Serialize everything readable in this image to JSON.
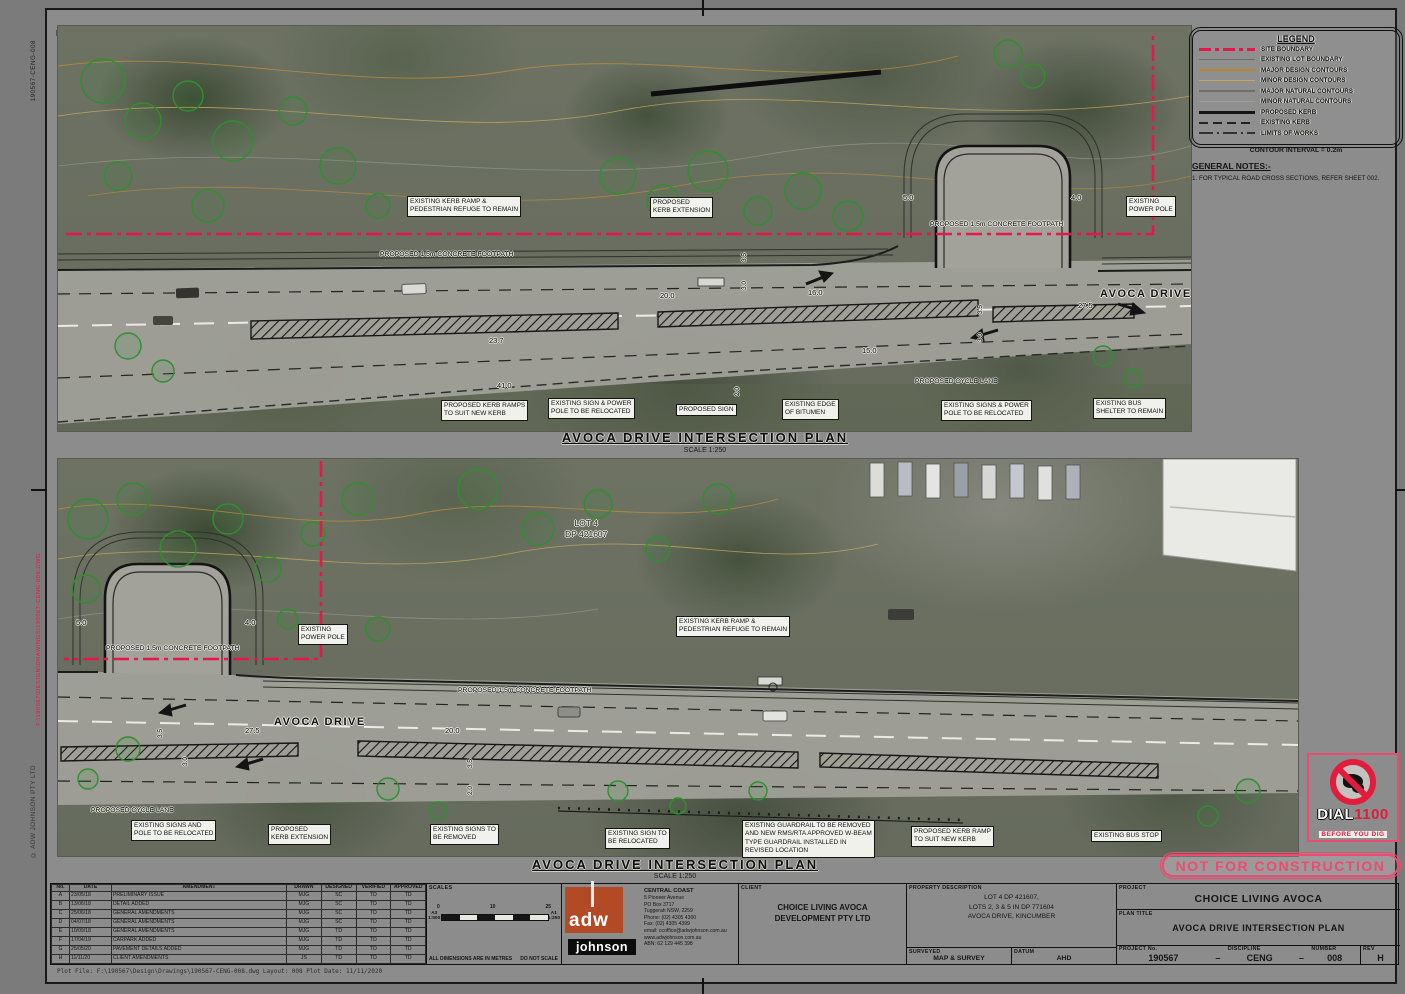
{
  "sheet": {
    "paper_color": "#8c8c8c",
    "accent_red": "#e8174a",
    "stamp_pink": "#ef4a70"
  },
  "north_label": "N",
  "vertical_margin_texts": {
    "drawing_ref": "190567-CENG-008",
    "red_stamp": "F:\\190567\\DESIGN\\DRAWINGS\\190567-CENG-008.DWG",
    "copyright": "© ADW JOHNSON PTY LTD"
  },
  "legend": {
    "title": "LEGEND",
    "items": [
      {
        "label": "SITE BOUNDARY",
        "line_class": "ls-site",
        "icon": "site-boundary-line-icon",
        "color": "#e8174a"
      },
      {
        "label": "EXISTING LOT BOUNDARY",
        "line_class": "ls-lot",
        "icon": "lot-boundary-line-icon",
        "color": "#6d6d66"
      },
      {
        "label": "MAJOR DESIGN CONTOURS",
        "line_class": "ls-majd",
        "icon": "major-design-contour-line-icon",
        "color": "#b5872f"
      },
      {
        "label": "MINOR DESIGN CONTOURS",
        "line_class": "ls-mind",
        "icon": "minor-design-contour-line-icon",
        "color": "#c7a55c"
      },
      {
        "label": "MAJOR NATURAL CONTOURS",
        "line_class": "ls-majn",
        "icon": "major-natural-contour-line-icon",
        "color": "#70706a"
      },
      {
        "label": "MINOR NATURAL CONTOURS",
        "line_class": "ls-minn",
        "icon": "minor-natural-contour-line-icon",
        "color": "#9d9d95"
      },
      {
        "label": "PROPOSED KERB",
        "line_class": "ls-pkerb",
        "icon": "proposed-kerb-line-icon",
        "color": "#151515"
      },
      {
        "label": "EXISTING KERB",
        "line_class": "ls-ekerb",
        "icon": "existing-kerb-line-icon",
        "color": "#222222"
      },
      {
        "label": "LIMITS OF WORKS",
        "line_class": "ls-limits",
        "icon": "limits-of-works-line-icon",
        "color": "#333333"
      }
    ],
    "contour_interval": "CONTOUR INTERVAL = 0.2m"
  },
  "general_notes": {
    "title": "GENERAL NOTES:-",
    "notes": [
      "1.  FOR TYPICAL ROAD CROSS SECTIONS, REFER SHEET 002."
    ]
  },
  "plans": [
    {
      "title": "AVOCA DRIVE INTERSECTION PLAN",
      "subtitle": "SCALE 1:250",
      "labels": [
        {
          "kind": "box",
          "x": 407,
          "y": 196,
          "text": "EXISTING KERB RAMP &\nPEDESTRIAN REFUGE TO REMAIN"
        },
        {
          "kind": "box",
          "x": 650,
          "y": 197,
          "text": "PROPOSED\nKERB EXTENSION"
        },
        {
          "kind": "plain",
          "x": 930,
          "y": 221,
          "text": "PROPOSED 1.5m CONCRETE FOOTPATH"
        },
        {
          "kind": "box",
          "x": 1126,
          "y": 196,
          "text": "EXISTING\nPOWER POLE"
        },
        {
          "kind": "plain",
          "x": 380,
          "y": 251,
          "text": "PROPOSED 1.5m CONCRETE FOOTPATH"
        },
        {
          "kind": "road",
          "x": 1100,
          "y": 288,
          "text": "AVOCA DRIVE"
        },
        {
          "kind": "plain",
          "x": 915,
          "y": 378,
          "text": "PROPOSED CYCLE LANE"
        },
        {
          "kind": "box",
          "x": 441,
          "y": 400,
          "text": "PROPOSED KERB RAMPS\nTO SUIT NEW KERB"
        },
        {
          "kind": "box",
          "x": 548,
          "y": 398,
          "text": "EXISTING SIGN & POWER\nPOLE TO BE RELOCATED"
        },
        {
          "kind": "box",
          "x": 676,
          "y": 404,
          "text": "PROPOSED SIGN"
        },
        {
          "kind": "box",
          "x": 782,
          "y": 399,
          "text": "EXISTING EDGE\nOF BITUMEN"
        },
        {
          "kind": "box",
          "x": 941,
          "y": 400,
          "text": "EXISTING SIGNS & POWER\nPOLE TO BE RELOCATED"
        },
        {
          "kind": "box",
          "x": 1093,
          "y": 398,
          "text": "EXISTING BUS\nSHELTER TO REMAIN"
        },
        {
          "kind": "dim",
          "x": 903,
          "y": 193,
          "text": "5.0"
        },
        {
          "kind": "dim",
          "x": 1071,
          "y": 193,
          "text": "4.0"
        },
        {
          "kind": "dim",
          "x": 660,
          "y": 291,
          "text": "20.0"
        },
        {
          "kind": "dim",
          "x": 808,
          "y": 288,
          "text": "16.0"
        },
        {
          "kind": "dim",
          "x": 1078,
          "y": 301,
          "text": "27.5"
        },
        {
          "kind": "dim",
          "x": 489,
          "y": 336,
          "text": "23.7"
        },
        {
          "kind": "dim",
          "x": 862,
          "y": 346,
          "text": "15.0"
        },
        {
          "kind": "dim",
          "x": 497,
          "y": 381,
          "text": "41.0"
        },
        {
          "kind": "vdim",
          "x": 741,
          "y": 262,
          "text": "3.5"
        },
        {
          "kind": "vdim",
          "x": 741,
          "y": 290,
          "text": "3.0"
        },
        {
          "kind": "vdim",
          "x": 977,
          "y": 314,
          "text": "3.5"
        },
        {
          "kind": "vdim",
          "x": 977,
          "y": 342,
          "text": "3.0"
        },
        {
          "kind": "vdim",
          "x": 734,
          "y": 396,
          "text": "2.0"
        }
      ]
    },
    {
      "title": "AVOCA DRIVE INTERSECTION PLAN",
      "subtitle": "SCALE 1:250",
      "labels": [
        {
          "kind": "dim",
          "x": 76,
          "y": 618,
          "text": "5.0"
        },
        {
          "kind": "dim",
          "x": 245,
          "y": 618,
          "text": "4.0"
        },
        {
          "kind": "box",
          "x": 298,
          "y": 624,
          "text": "EXISTING\nPOWER POLE"
        },
        {
          "kind": "plain",
          "x": 106,
          "y": 645,
          "text": "PROPOSED 1.5m CONCRETE FOOTPATH"
        },
        {
          "kind": "box",
          "x": 676,
          "y": 616,
          "text": "EXISTING KERB RAMP &\nPEDESTRIAN REFUGE TO REMAIN"
        },
        {
          "kind": "plain",
          "x": 458,
          "y": 687,
          "text": "PROPOSED 1.5m CONCRETE FOOTPATH"
        },
        {
          "kind": "road",
          "x": 274,
          "y": 716,
          "text": "AVOCA DRIVE"
        },
        {
          "kind": "lot",
          "x": 565,
          "y": 518,
          "text": "LOT 4\nDP 421607"
        },
        {
          "kind": "dim",
          "x": 245,
          "y": 726,
          "text": "27.5"
        },
        {
          "kind": "dim",
          "x": 445,
          "y": 726,
          "text": "20.0"
        },
        {
          "kind": "vdim",
          "x": 157,
          "y": 738,
          "text": "3.5"
        },
        {
          "kind": "vdim",
          "x": 182,
          "y": 766,
          "text": "3.0"
        },
        {
          "kind": "vdim",
          "x": 467,
          "y": 768,
          "text": "3.5"
        },
        {
          "kind": "vdim",
          "x": 467,
          "y": 795,
          "text": "2.0"
        },
        {
          "kind": "plain",
          "x": 91,
          "y": 807,
          "text": "PROPOSED CYCLE LANE"
        },
        {
          "kind": "box",
          "x": 131,
          "y": 820,
          "text": "EXISTING SIGNS AND\nPOLE TO BE RELOCATED"
        },
        {
          "kind": "box",
          "x": 268,
          "y": 824,
          "text": "PROPOSED\nKERB EXTENSION"
        },
        {
          "kind": "box",
          "x": 430,
          "y": 824,
          "text": "EXISTING SIGNS TO\nBE REMOVED"
        },
        {
          "kind": "box",
          "x": 605,
          "y": 828,
          "text": "EXISTING SIGN TO\nBE RELOCATED"
        },
        {
          "kind": "box",
          "x": 742,
          "y": 820,
          "text": "EXISTING GUARDRAIL TO BE REMOVED\nAND NEW RMS/RTA APPROVED W-BEAM\nTYPE GUARDRAIL INSTALLED IN\nREVISED LOCATION"
        },
        {
          "kind": "box",
          "x": 911,
          "y": 826,
          "text": "PROPOSED KERB RAMP\nTO SUIT NEW KERB"
        },
        {
          "kind": "box",
          "x": 1091,
          "y": 830,
          "text": "EXISTING BUS STOP"
        }
      ]
    }
  ],
  "stamps": {
    "not_for_construction": "NOT FOR CONSTRUCTION",
    "dial": {
      "line1": "DIAL",
      "line2": "1100",
      "line3": "BEFORE YOU DIG"
    }
  },
  "title_block": {
    "revision_table": {
      "headers": [
        "No.",
        "DATE",
        "AMENDMENT",
        "DRAWN",
        "DESIGNED",
        "VERIFIED",
        "APPROVED"
      ],
      "rows": [
        [
          "A",
          "23/05/18",
          "PRELIMINARY ISSUE",
          "MJG",
          "SC",
          "TD",
          "TD"
        ],
        [
          "B",
          "13/06/18",
          "DETAIL ADDED",
          "MJG",
          "SC",
          "TD",
          "TD"
        ],
        [
          "C",
          "25/06/18",
          "GENERAL AMENDMENTS",
          "MJG",
          "SC",
          "TD",
          "TD"
        ],
        [
          "D",
          "04/07/18",
          "GENERAL AMENDMENTS",
          "MJG",
          "SC",
          "TD",
          "TD"
        ],
        [
          "E",
          "10/09/18",
          "GENERAL AMENDMENTS",
          "MJG",
          "TD",
          "TD",
          "TD"
        ],
        [
          "F",
          "17/04/19",
          "CARPARK ADDED",
          "MJG",
          "TD",
          "TD",
          "TD"
        ],
        [
          "G",
          "25/05/20",
          "PAVEMENT DETAILS ADDED",
          "MJG",
          "TD",
          "TD",
          "TD"
        ],
        [
          "H",
          "11/11/20",
          "CLIENT AMENDMENTS",
          "JS",
          "TD",
          "TD",
          "TD"
        ]
      ]
    },
    "scales": {
      "label": "SCALES",
      "ticks": [
        "0",
        "10",
        "25"
      ],
      "bar_left": "A3\n1:500",
      "bar_right": "A1\n1:250",
      "dimensions_note": "ALL DIMENSIONS ARE IN METRES",
      "do_not_scale": "DO NOT SCALE"
    },
    "firm": {
      "name_top": "adw",
      "name_bottom": "johnson",
      "office": "CENTRAL COAST",
      "address": [
        "5 Pioneer Avenue",
        "PO Box 3717",
        "Tuggerah NSW, 2259",
        "Phone: (02) 4305 4300",
        "Fax:     (02) 4305 4399",
        "email: ccoffice@adwjohnson.com.au",
        "www.adwjohnson.com.au",
        "ABN: 62 129 445 398"
      ]
    },
    "client": {
      "header": "CLIENT",
      "name": "CHOICE LIVING AVOCA\nDEVELOPMENT PTY LTD"
    },
    "property": {
      "header": "PROPERTY DESCRIPTION",
      "description": "LOT 4 DP 421607,\nLOTS 2, 3 & 5 IN DP 771604\nAVOCA DRIVE, KINCUMBER",
      "surveyed_label": "SURVEYED",
      "surveyed_value": "MAP & SURVEY",
      "datum_label": "DATUM",
      "datum_value": "AHD"
    },
    "project": {
      "header": "PROJECT",
      "name": "CHOICE LIVING AVOCA",
      "title_header": "PLAN TITLE",
      "title": "AVOCA DRIVE INTERSECTION PLAN",
      "project_no_label": "PROJECT No.",
      "project_no": "190567",
      "discipline_label": "DISCIPLINE",
      "discipline": "CENG",
      "number_label": "NUMBER",
      "number": "008",
      "rev_label": "REV",
      "rev": "H",
      "separator": "–"
    },
    "plot_line": "Plot File: F:\\190567\\Design\\Drawings\\190567-CENG-008.dwg    Layout: 008    Plot Date: 11/11/2020"
  }
}
